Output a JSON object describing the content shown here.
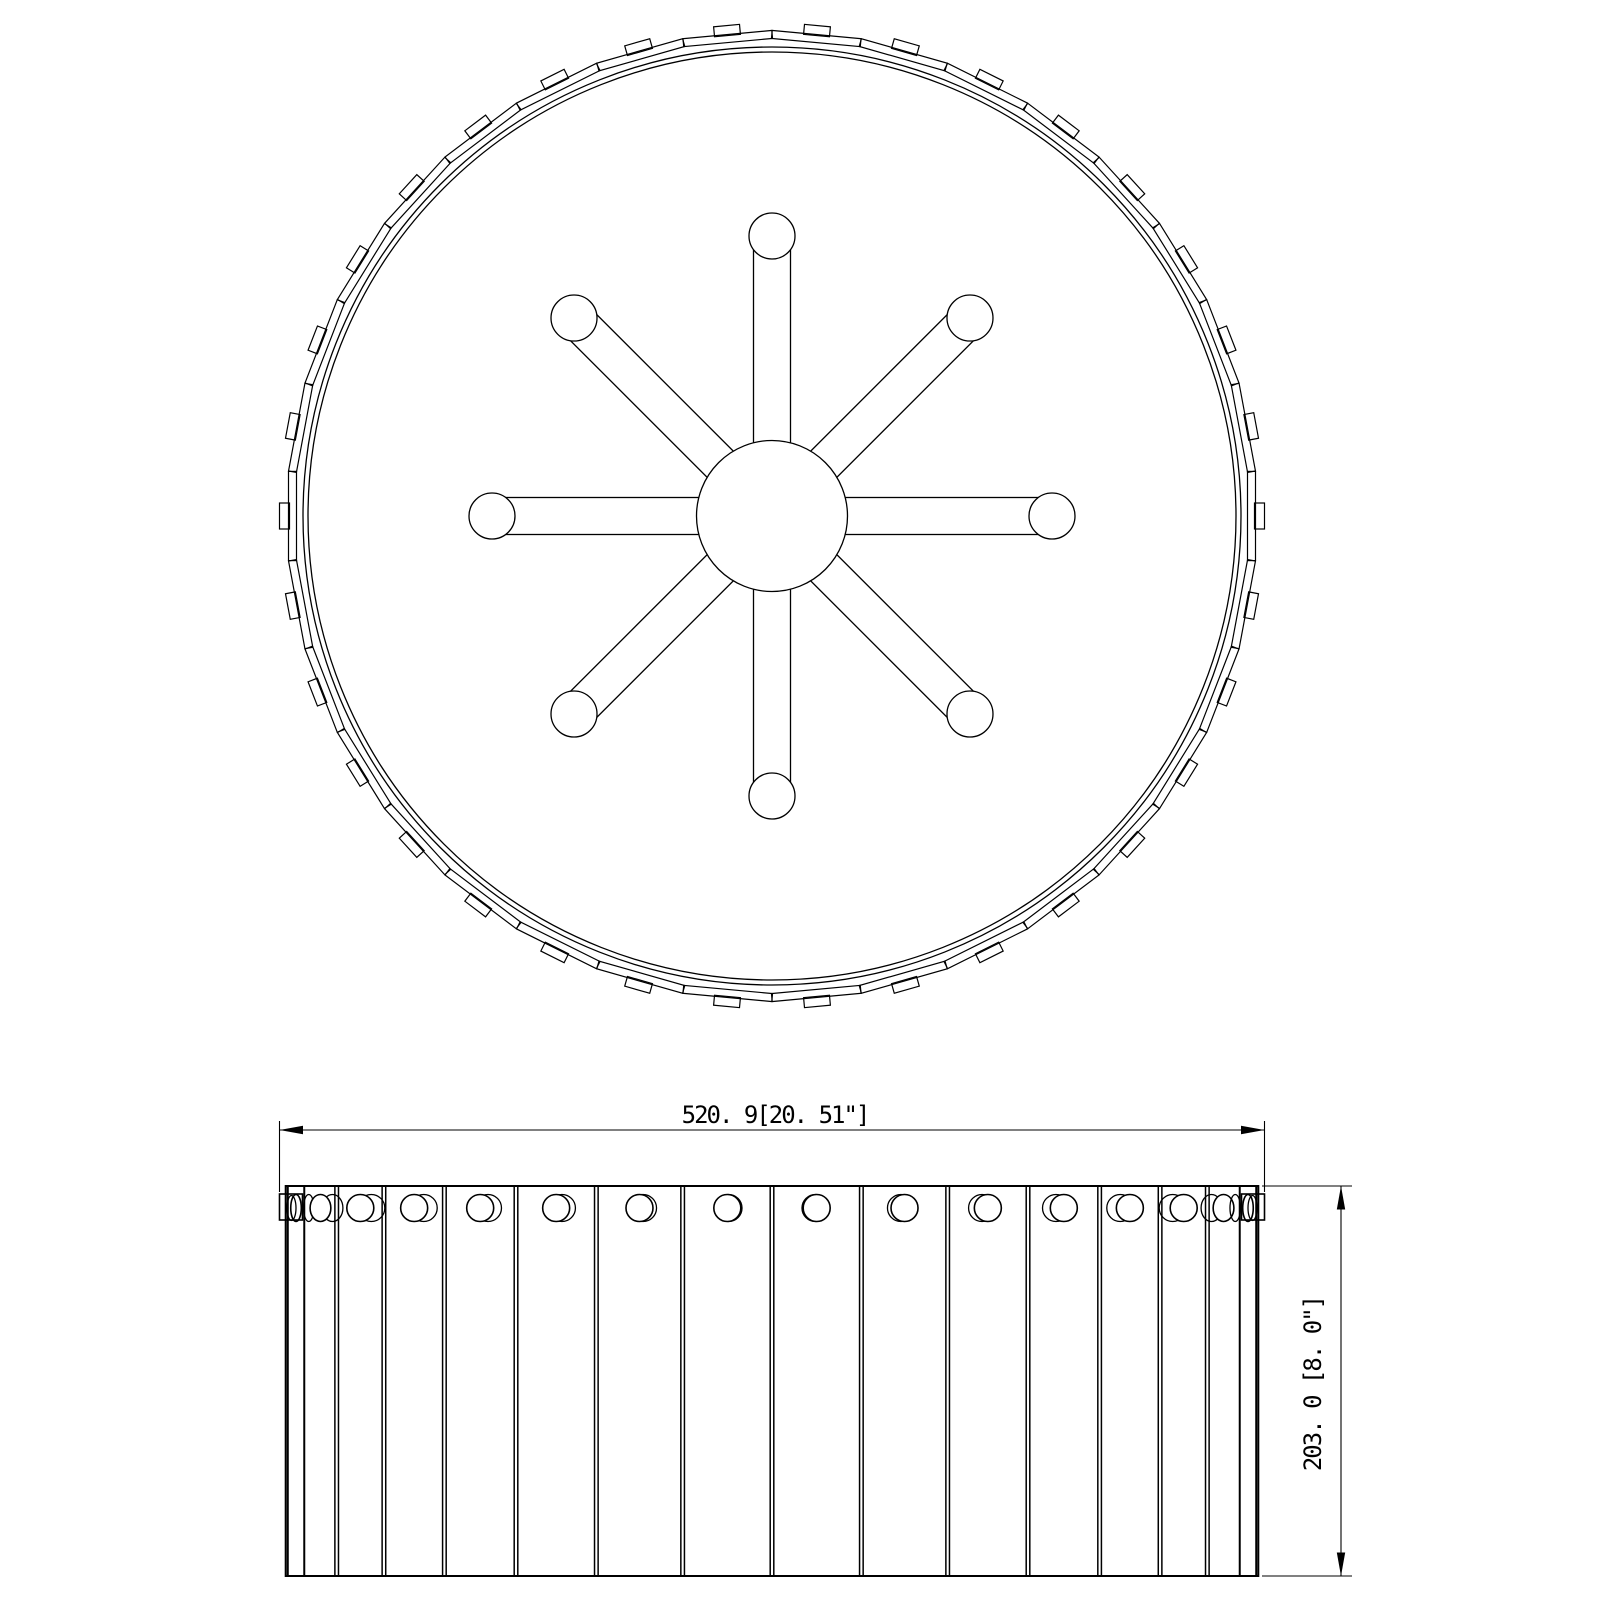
{
  "drawing": {
    "type": "technical-line-drawing",
    "subject": "drum shade ceiling light fixture - plan and elevation views",
    "colors": {
      "background": "#ffffff",
      "line": "#000000"
    },
    "views": {
      "plan": {
        "name": "top view",
        "panel_count": 34,
        "clip_count": 34,
        "spoke_arm_count": 8,
        "lamp_circle_count": 8
      },
      "elevation": {
        "name": "front view",
        "visible_slat_count": 18,
        "finial_count": 16,
        "edge_clip_count": 2
      }
    },
    "dimensions": {
      "width": {
        "label": "520. 9[20. 51\"]",
        "mm": 520.9,
        "inches": 20.51
      },
      "height": {
        "label": "203. 0 [8. 0\"]",
        "mm": 203.0,
        "inches": 8.0
      }
    }
  }
}
